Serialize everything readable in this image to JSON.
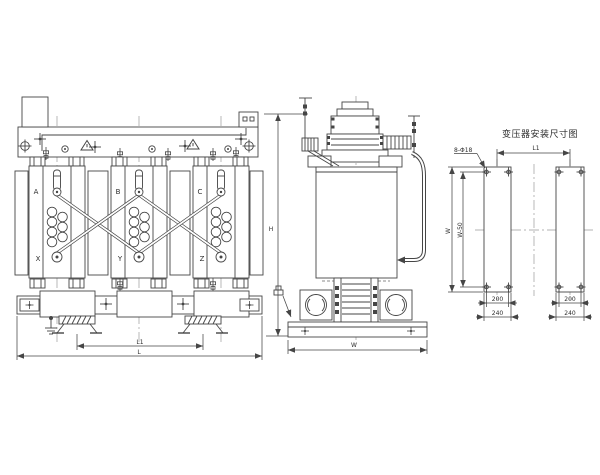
{
  "drawing": {
    "type": "transformer-outline-engineering-drawing",
    "views": {
      "front": {
        "phase_top_labels": [
          "A",
          "B",
          "C"
        ],
        "phase_bottom_labels": [
          "X",
          "Y",
          "Z"
        ],
        "dims": {
          "wheel_span": "L1",
          "overall_length": "L",
          "overall_height": "H"
        }
      },
      "side": {
        "dims": {
          "overall_width": "W"
        }
      },
      "installation": {
        "title": "变压器安装尺寸图",
        "hole_callout": "8-Φ18",
        "dims": {
          "rail_center_span": "L1",
          "overall_width": "W",
          "hole_row_span": "W-50",
          "hole_col_span": "200",
          "rail_width": "240"
        }
      }
    },
    "colors": {
      "line": "#454545",
      "centerline": "#9a9a9a",
      "text": "#2e2e2e",
      "background": "#ffffff"
    }
  }
}
